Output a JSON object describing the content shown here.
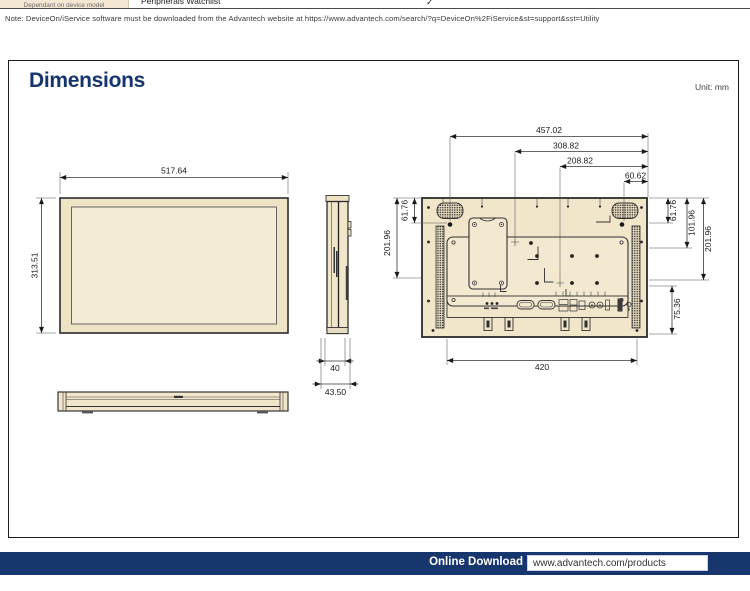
{
  "header_row": {
    "left_cell": "Dependant on device model",
    "label": "Peripherals Watchlist",
    "check": "✓"
  },
  "note": "Note: DeviceOn/iService software must be downloaded from the Advantech website at https://www.advantech.com/search/?q=DeviceOn%2FiService&st=support&sst=Utility",
  "section": {
    "title": "Dimensions",
    "unit": "Unit: mm"
  },
  "dims": {
    "front_width": "517.64",
    "front_height": "313.51",
    "side_width": "40",
    "side_depth": "43.50",
    "rear_top": "457.02",
    "rear_mid": "308.82",
    "rear_inner": "208.82",
    "rear_offset": "60.62",
    "rear_left_top": "61.76",
    "rear_left_span": "201.96",
    "rear_right_top": "61.76",
    "rear_right_mid": "101.96",
    "rear_right_span": "201.96",
    "rear_bottom_offset": "75.36",
    "rear_bottom_width": "420"
  },
  "footer": {
    "label": "Online Download",
    "url": "www.advantech.com/products"
  },
  "colors": {
    "accent": "#17366d",
    "drawing_fill": "#f1e5ca"
  }
}
